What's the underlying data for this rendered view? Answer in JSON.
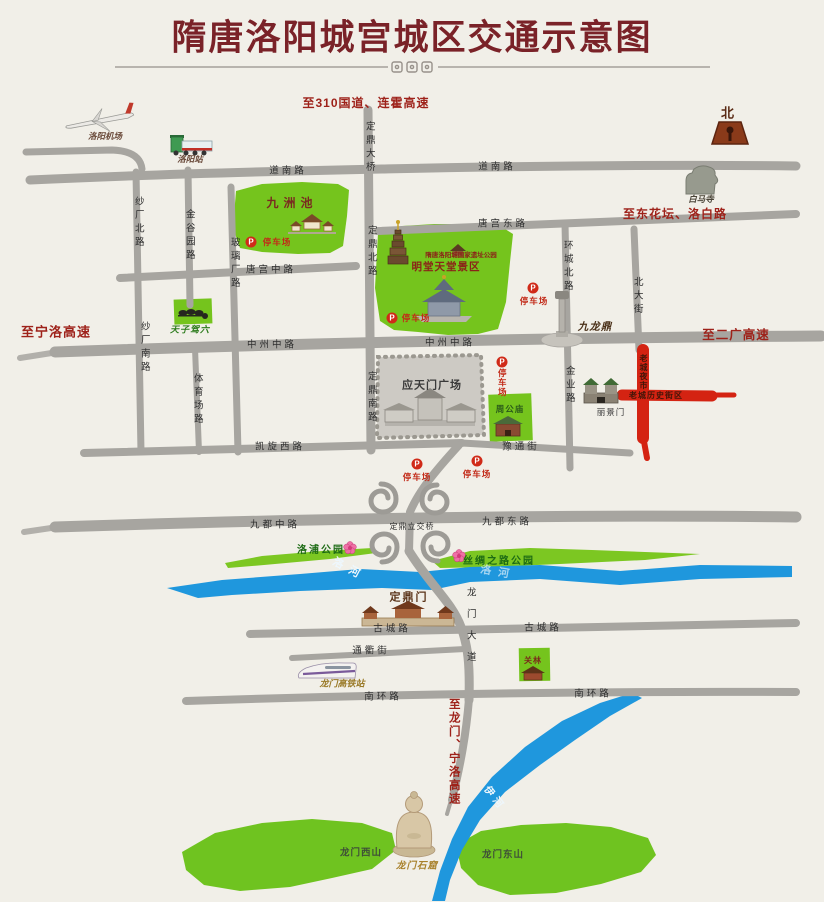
{
  "header": {
    "title": "隋唐洛阳城宫城区交通示意图"
  },
  "compass": {
    "north": "北"
  },
  "highways": {
    "g310": "至310国道、连霍高速",
    "ningluo": "至宁洛高速",
    "donghuatan": "至东花坛、洛白路",
    "erguang": "至二广高速",
    "tolongmen": "至龙门、宁洛高速"
  },
  "roads": {
    "daonan": "道南路",
    "tanggong_dong": "唐宫东路",
    "tanggong_zhong": "唐宫中路",
    "zhongzhou_zhong": "中州中路",
    "kaixuan_xi": "凯旋西路",
    "yutong": "豫通街",
    "jiudu_zhong": "九都中路",
    "dingding_lijiao": "定鼎立交桥",
    "jiudu_dong": "九都东路",
    "gucheng": "古城路",
    "tongqu": "通衢街",
    "nanhuan": "南环路",
    "shachang_bei": "纱厂北路",
    "shachang_nan": "纱厂南路",
    "jinguyuan": "金谷园路",
    "bolichang": "玻璃厂路",
    "tiyuchang": "体育场路",
    "dingding_daqiao": "定鼎大桥",
    "dingding_bei": "定鼎北路",
    "dingding_nan": "定鼎南路",
    "huancheng_bei": "环城北路",
    "jinye": "金业路",
    "beidajie": "北大街",
    "longmen_dadao": "龙门大道"
  },
  "rivers": {
    "luohe": "洛河",
    "yihe": "伊河"
  },
  "parks": {
    "jiuzhouchi": "九洲池",
    "yizhi_park": "隋唐洛阳城国家遗址公园",
    "mingtang": "明堂天堂景区",
    "luopu": "洛浦公园",
    "sichou": "丝绸之路公园",
    "tianzijialiu": "天子驾六",
    "zhougongmiao": "周公庙",
    "guanlin": "关林",
    "xishan": "龙门西山",
    "dongshan": "龙门东山"
  },
  "landmarks": {
    "yingtianmen": "应天门广场",
    "dingdingmen": "定鼎门",
    "lijingmen": "丽景门",
    "jiulongding": "九龙鼎",
    "baimasi": "白马寺",
    "shiku": "龙门石窟"
  },
  "transport": {
    "airport": "洛阳机场",
    "railway_station": "洛阳站",
    "hsr_station": "龙门高铁站"
  },
  "oldtown": {
    "vertical": "老城夜市",
    "horizontal": "老城历史街区"
  },
  "parking": {
    "symbol": "P",
    "label": "停车场"
  },
  "colors": {
    "title_red": "#7a2228",
    "highway_red": "#9e221a",
    "road_gray": "#a7a5a0",
    "park_green": "#75c41d",
    "river_blue": "#1f97dd",
    "parking_red": "#d02a18",
    "oldtown_red": "#d42312"
  }
}
